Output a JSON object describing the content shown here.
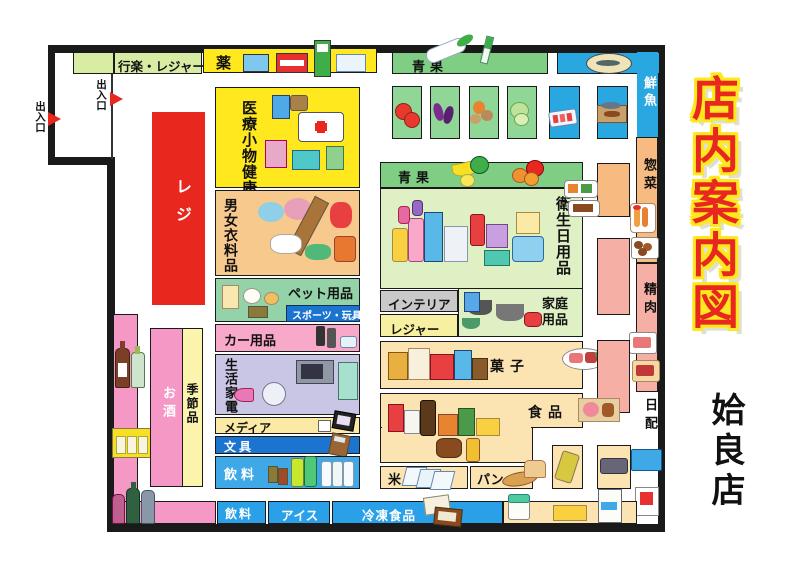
{
  "title": {
    "main": "店内案内図",
    "store": "姶良店"
  },
  "entrances": {
    "top": "出入口",
    "left": "出入口"
  },
  "sections": {
    "leisure_banner": "行楽・レジャー",
    "medicine": "薬",
    "produce_top": "青果",
    "fresh_fish": "鮮魚",
    "deli": "惣菜",
    "meat": "精肉",
    "daily_goods": "日配",
    "register": "レジ",
    "medical_health": "医療小物健康食品",
    "clothing": "男女衣料品",
    "pet": "ペット用品",
    "sports_toys": "スポーツ・玩具",
    "car": "カー用品",
    "appliances": "生活家電",
    "media": "メディア",
    "stationery": "文具",
    "beverages": "飲料",
    "alcohol": "お酒",
    "seasonal": "季節品",
    "produce_mid": "青果",
    "hygiene": "衛生日用品",
    "interior": "インテリア",
    "leisure": "レジャー",
    "household": "家庭用品",
    "sweets": "菓子",
    "food": "食品",
    "rice": "米",
    "bread": "パン",
    "beverages_bottom": "飲料",
    "ice_cream": "アイス",
    "frozen_food": "冷凍食品"
  },
  "palette": {
    "red": "#e8281e",
    "yellow": "#ffe81e",
    "banner_green": "#d9eca4",
    "produce_green": "#7fce83",
    "fish_blue": "#29a7e0",
    "deli_orange": "#f7ba80",
    "meat_salmon": "#f5afa4",
    "alcohol_pink": "#f598c5",
    "appliance_lavender": "#c9c5e4",
    "cream": "#fbe3b2",
    "pale_green": "#dff0c4",
    "deep_blue": "#1b74d0",
    "bottom_blue": "#29a0e8",
    "seasonal_yellow": "#fcf3ac",
    "interior_gray": "#c9c9c9",
    "leisure_pale_yellow": "#f7f0a0"
  }
}
